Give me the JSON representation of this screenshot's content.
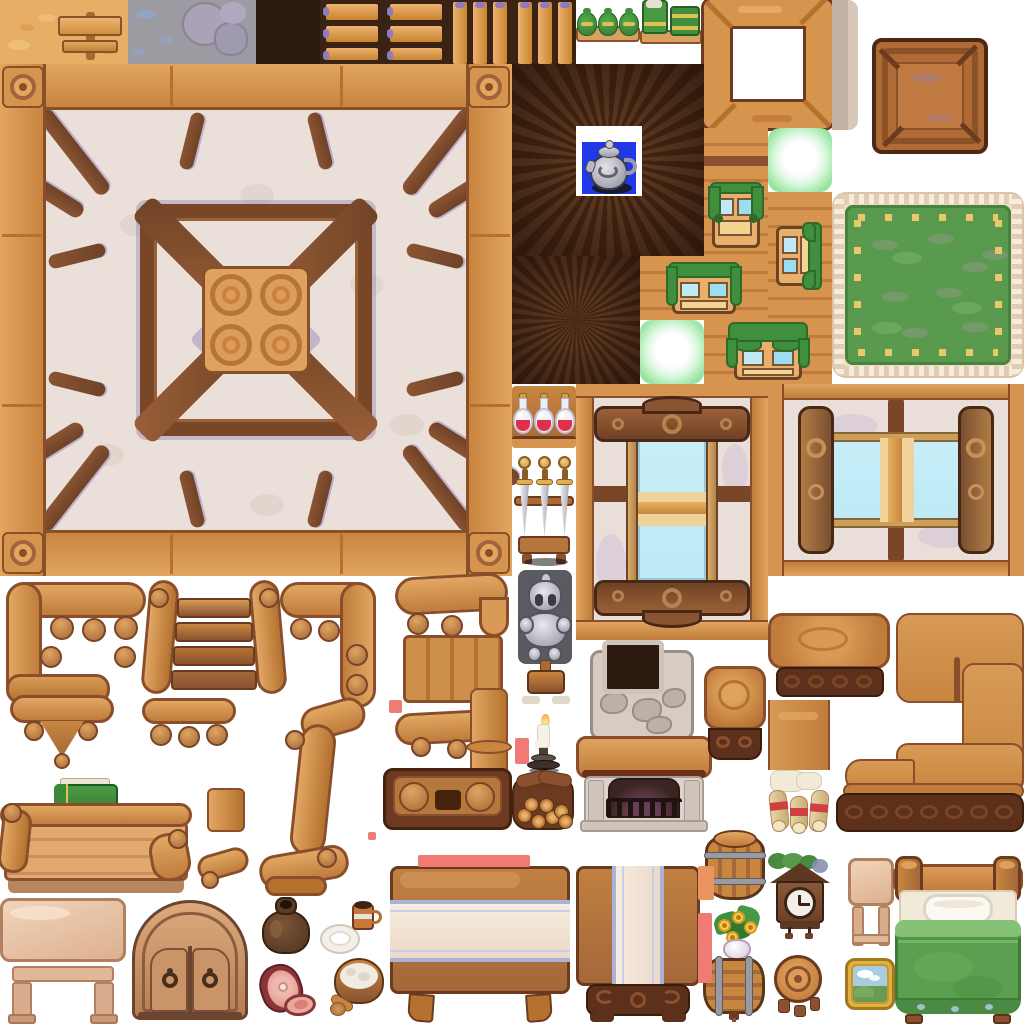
{
  "sheet": {
    "title": "Cozy wooden interior game tileset spritesheet",
    "width": 1024,
    "height": 1024,
    "background": "#ffffff",
    "grid": 64
  },
  "palette": {
    "wood": "#d6944f",
    "woodLight": "#e8b06a",
    "woodMid": "#c07c3c",
    "woodDark": "#8a4f2a",
    "outline": "#6b3a1f",
    "beam": "#7a4628",
    "beamLight": "#9a6038",
    "plaster": "#eae0d9",
    "plasterShadow": "#cfc0c6",
    "purpleAccent": "#9b86bf",
    "darkPlank": "#46281a",
    "darkVoid": "#2d1a10",
    "curtainGreen": "#3f8f3f",
    "curtainGreenDark": "#2c6b2c",
    "carpetGreen": "#5a9a4e",
    "carpetTrim": "#eddcc6",
    "carpetDash": "#e8c868",
    "glassBlue": "#c6eef8",
    "glassTan": "#eed29a",
    "stoneGray": "#9b9ba1",
    "sandTan": "#e7ae66",
    "clothCream": "#f4e8da",
    "clothStripeBlue": "#a8b2da",
    "glowGreen": "#7bd689",
    "potBlue": "#2038e8",
    "armorSilver": "#b9b9c2",
    "potionRed": "#e03048",
    "markerSalmon": "#f07b74",
    "markerOrange": "#e8955f",
    "frameGold": "#e0b040",
    "blanketGreen": "#5aa050",
    "paleWood": "#e9c6a9",
    "stoneHearth": "#d7ccc3"
  },
  "sprites": [
    {
      "id": "tile-sand",
      "label": "sand ground tile with wooden signpost",
      "x": 0,
      "y": 0,
      "w": 128,
      "h": 64
    },
    {
      "id": "tile-stone",
      "label": "gray stone ground tile with boulders",
      "x": 128,
      "y": 0,
      "w": 128,
      "h": 64
    },
    {
      "id": "tile-dark",
      "label": "dark void tile",
      "x": 256,
      "y": 0,
      "w": 64,
      "h": 64
    },
    {
      "id": "shelf-h",
      "label": "shelf tile with horizontal planks",
      "x": 320,
      "y": 0,
      "w": 128,
      "h": 64
    },
    {
      "id": "shelf-v",
      "label": "shelf tile with vertical planks",
      "x": 448,
      "y": 0,
      "w": 128,
      "h": 64
    },
    {
      "id": "sacks-green",
      "label": "board with green sacks",
      "x": 576,
      "y": 0,
      "w": 64,
      "h": 44
    },
    {
      "id": "mats-green",
      "label": "board with green bundles",
      "x": 640,
      "y": 0,
      "w": 62,
      "h": 46
    },
    {
      "id": "frame-wood",
      "label": "empty wooden frame tile",
      "x": 704,
      "y": 0,
      "w": 128,
      "h": 128
    },
    {
      "id": "wall-strip-tan",
      "label": "tan wall fragment",
      "x": 832,
      "y": 0,
      "w": 26,
      "h": 130
    },
    {
      "id": "crate",
      "label": "wooden crate lid",
      "x": 872,
      "y": 38,
      "w": 116,
      "h": 116
    },
    {
      "id": "ceiling-main",
      "label": "large timber-framed ceiling tile",
      "x": 0,
      "y": 64,
      "w": 512,
      "h": 512
    },
    {
      "id": "floor-dark-kettle",
      "label": "dark plank vortex floor with silver kettle opening",
      "x": 512,
      "y": 64,
      "w": 192,
      "h": 192
    },
    {
      "id": "window-up",
      "label": "wall window with green curtains facing up",
      "x": 704,
      "y": 128,
      "w": 64,
      "h": 128
    },
    {
      "id": "glow-a",
      "label": "green glow light tile",
      "x": 768,
      "y": 128,
      "w": 64,
      "h": 64
    },
    {
      "id": "window-side",
      "label": "wall window with green curtains facing side",
      "x": 768,
      "y": 192,
      "w": 64,
      "h": 128
    },
    {
      "id": "window-h1",
      "label": "wall window with green curtains horizontal",
      "x": 640,
      "y": 256,
      "w": 128,
      "h": 64
    },
    {
      "id": "glow-b",
      "label": "green glow light tile",
      "x": 640,
      "y": 320,
      "w": 64,
      "h": 64
    },
    {
      "id": "window-h2",
      "label": "wall window with green valance horizontal",
      "x": 704,
      "y": 320,
      "w": 128,
      "h": 64
    },
    {
      "id": "floor-dark",
      "label": "dark plank vortex floor tile",
      "x": 512,
      "y": 256,
      "w": 128,
      "h": 128
    },
    {
      "id": "carpet",
      "label": "green rug with fringed border and yellow stitches",
      "x": 832,
      "y": 192,
      "w": 192,
      "h": 186
    },
    {
      "id": "potions",
      "label": "shelf with red potion flasks",
      "x": 512,
      "y": 386,
      "w": 64,
      "h": 70
    },
    {
      "id": "swords",
      "label": "sword display rack with three swords",
      "x": 512,
      "y": 452,
      "w": 64,
      "h": 114
    },
    {
      "id": "knight",
      "label": "knight armor statue on pedestal",
      "x": 514,
      "y": 564,
      "w": 62,
      "h": 148
    },
    {
      "id": "candle",
      "label": "lit candle on pewter stand",
      "x": 522,
      "y": 714,
      "w": 46,
      "h": 58
    },
    {
      "id": "firewood",
      "label": "firewood pile",
      "x": 510,
      "y": 770,
      "w": 66,
      "h": 62
    },
    {
      "id": "window-big-v",
      "label": "large ornate window wall vertical",
      "x": 576,
      "y": 384,
      "w": 192,
      "h": 256
    },
    {
      "id": "window-big-h",
      "label": "large ornate window wall horizontal",
      "x": 768,
      "y": 384,
      "w": 256,
      "h": 192
    },
    {
      "id": "fireplace",
      "label": "stone fireplace with chimney and grate",
      "x": 576,
      "y": 640,
      "w": 136,
      "h": 192
    },
    {
      "id": "stool-a",
      "label": "square stool top view",
      "x": 704,
      "y": 666,
      "w": 62,
      "h": 96
    },
    {
      "id": "table-end",
      "label": "counter end section with carved base",
      "x": 768,
      "y": 613,
      "w": 126,
      "h": 86
    },
    {
      "id": "counter-c",
      "label": "L-shaped counter with carved base",
      "x": 835,
      "y": 613,
      "w": 189,
      "h": 219
    },
    {
      "id": "table-mid",
      "label": "counter middle section",
      "x": 768,
      "y": 700,
      "w": 62,
      "h": 70
    },
    {
      "id": "scrolls",
      "label": "parchment scrolls with red ribbons",
      "x": 766,
      "y": 768,
      "w": 66,
      "h": 64
    },
    {
      "id": "bench-corner-l",
      "label": "bench frame corner left with spindles",
      "x": 0,
      "y": 578,
      "w": 152,
      "h": 132
    },
    {
      "id": "steps",
      "label": "wooden steps with side rails",
      "x": 145,
      "y": 578,
      "w": 138,
      "h": 122
    },
    {
      "id": "bench-corner-r",
      "label": "bench frame corner right",
      "x": 278,
      "y": 578,
      "w": 102,
      "h": 132
    },
    {
      "id": "pendant",
      "label": "carved pendant bracket",
      "x": 8,
      "y": 695,
      "w": 108,
      "h": 78
    },
    {
      "id": "post-balls",
      "label": "rail with ball spindles",
      "x": 138,
      "y": 698,
      "w": 102,
      "h": 68
    },
    {
      "id": "bench-scurve",
      "label": "S-curved bench leg",
      "x": 255,
      "y": 700,
      "w": 115,
      "h": 198
    },
    {
      "id": "book-green",
      "label": "green book with gold clasps",
      "x": 52,
      "y": 776,
      "w": 70,
      "h": 50
    },
    {
      "id": "post-frag",
      "label": "post fragment",
      "x": 203,
      "y": 788,
      "w": 46,
      "h": 44
    },
    {
      "id": "bench-low",
      "label": "low bench with plank back",
      "x": 0,
      "y": 803,
      "w": 192,
      "h": 95
    },
    {
      "id": "rail-frag-a",
      "label": "curved rail fragment",
      "x": 193,
      "y": 843,
      "w": 62,
      "h": 52
    },
    {
      "id": "bench-back-r",
      "label": "bench back with swoosh rail",
      "x": 393,
      "y": 573,
      "w": 119,
      "h": 132
    },
    {
      "id": "rail-bottom-r",
      "label": "bottom swoosh rail with spindles",
      "x": 393,
      "y": 705,
      "w": 119,
      "h": 62
    },
    {
      "id": "column-frag",
      "label": "column fragment with collar",
      "x": 466,
      "y": 688,
      "w": 46,
      "h": 112
    },
    {
      "id": "foot-block",
      "label": "carved bench foot block",
      "x": 383,
      "y": 768,
      "w": 129,
      "h": 62
    },
    {
      "id": "table-light",
      "label": "light wood table with shelf",
      "x": 0,
      "y": 898,
      "w": 126,
      "h": 126
    },
    {
      "id": "cabinet",
      "label": "arched cabinet with ring handles",
      "x": 128,
      "y": 898,
      "w": 124,
      "h": 126
    },
    {
      "id": "sack",
      "label": "brown sack",
      "x": 260,
      "y": 896,
      "w": 52,
      "h": 60
    },
    {
      "id": "plate",
      "label": "white plate",
      "x": 320,
      "y": 920,
      "w": 40,
      "h": 36
    },
    {
      "id": "mug",
      "label": "tankard mug",
      "x": 352,
      "y": 900,
      "w": 30,
      "h": 30
    },
    {
      "id": "ham",
      "label": "cut ham with slice",
      "x": 256,
      "y": 960,
      "w": 62,
      "h": 58
    },
    {
      "id": "bowl",
      "label": "wooden bowl with porridge and spoon",
      "x": 330,
      "y": 956,
      "w": 56,
      "h": 60
    },
    {
      "id": "table-cloth-h",
      "label": "table with striped cloth wide",
      "x": 388,
      "y": 866,
      "w": 184,
      "h": 156
    },
    {
      "id": "table-cloth-v",
      "label": "table with striped runner narrow",
      "x": 574,
      "y": 866,
      "w": 128,
      "h": 156
    },
    {
      "id": "barrel-up",
      "label": "upright barrel with hoops",
      "x": 703,
      "y": 830,
      "w": 64,
      "h": 72
    },
    {
      "id": "flowers",
      "label": "potted yellow flowers",
      "x": 714,
      "y": 903,
      "w": 46,
      "h": 58
    },
    {
      "id": "barrel-side",
      "label": "barrel on side with spigot",
      "x": 701,
      "y": 956,
      "w": 66,
      "h": 66
    },
    {
      "id": "clock",
      "label": "cuckoo clock with foliage roof",
      "x": 768,
      "y": 853,
      "w": 64,
      "h": 86
    },
    {
      "id": "stool-b",
      "label": "round stool top view",
      "x": 772,
      "y": 953,
      "w": 52,
      "h": 64
    },
    {
      "id": "table-side-light",
      "label": "light wood side table",
      "x": 848,
      "y": 858,
      "w": 46,
      "h": 97
    },
    {
      "id": "painting",
      "label": "gold framed landscape painting",
      "x": 845,
      "y": 958,
      "w": 50,
      "h": 52
    },
    {
      "id": "bed",
      "label": "bed with green blanket and pillow",
      "x": 893,
      "y": 856,
      "w": 130,
      "h": 168
    },
    {
      "id": "marker-1",
      "label": "salmon placeholder marker bar",
      "type": "marker",
      "color": "#f07b74",
      "x": 418,
      "y": 855,
      "w": 112,
      "h": 12
    },
    {
      "id": "marker-2",
      "label": "orange placeholder marker",
      "type": "marker",
      "color": "#e8955f",
      "x": 698,
      "y": 866,
      "w": 16,
      "h": 34
    },
    {
      "id": "marker-3",
      "label": "salmon placeholder marker",
      "type": "marker",
      "color": "#f07b74",
      "x": 698,
      "y": 913,
      "w": 14,
      "h": 70
    },
    {
      "id": "marker-4",
      "label": "salmon placeholder marker",
      "type": "marker",
      "color": "#f07b74",
      "x": 515,
      "y": 738,
      "w": 14,
      "h": 26
    },
    {
      "id": "marker-5",
      "label": "salmon placeholder marker",
      "type": "marker",
      "color": "#f07b74",
      "x": 389,
      "y": 700,
      "w": 13,
      "h": 13
    },
    {
      "id": "marker-6",
      "label": "salmon placeholder marker",
      "type": "marker",
      "color": "#f07b74",
      "x": 368,
      "y": 832,
      "w": 8,
      "h": 8
    }
  ]
}
